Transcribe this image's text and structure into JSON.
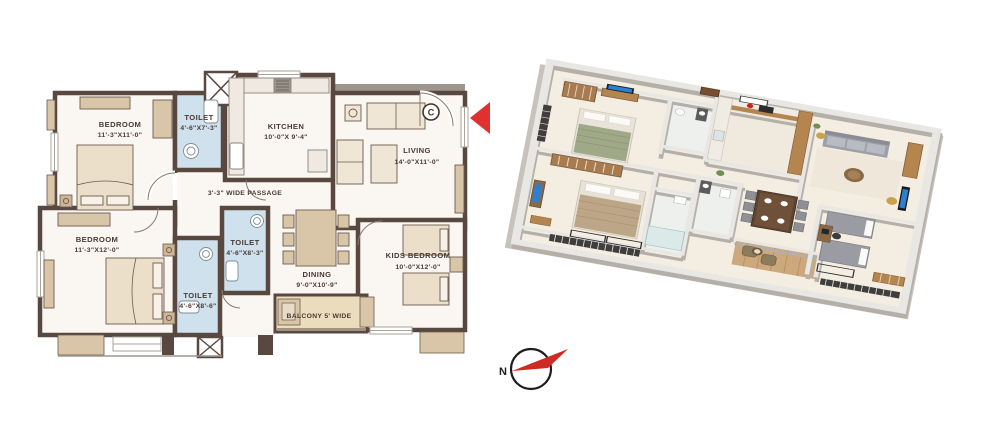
{
  "plan_2d": {
    "rooms": {
      "bedroom_top": {
        "name": "BEDROOM",
        "dims": "11'-3\"X11'-0\""
      },
      "toilet_top": {
        "name": "TOILET",
        "dims": "4'-6\"X7'-3\""
      },
      "kitchen": {
        "name": "KITCHEN",
        "dims": "10'-0\"X 9'-4\""
      },
      "living": {
        "name": "LIVING",
        "dims": "14'-0\"X11'-0\""
      },
      "bedroom_bottom": {
        "name": "BEDROOM",
        "dims": "11'-3\"X12'-0\""
      },
      "toilet_bottom": {
        "name": "TOILET",
        "dims": "4'-6\"X8'-6\""
      },
      "toilet_mid": {
        "name": "TOILET",
        "dims": "4'-6\"X8'-3\""
      },
      "dining": {
        "name": "DINING",
        "dims": "9'-0\"X10'-9\""
      },
      "kids_bedroom": {
        "name": "KIDS BEDROOM",
        "dims": "10'-0\"X12'-0\""
      }
    },
    "passage_label": "3'-3\" WIDE PASSAGE",
    "balcony_label": "BALCONY 5' WIDE",
    "entry_marker": "C"
  },
  "compass": {
    "north_label": "N"
  },
  "colors": {
    "wall": "#584840",
    "toilet_fill": "#cfe1ec",
    "furniture_tan": "#d9c6a8",
    "balcony_fill": "#ecdcbe",
    "arrow_red": "#e03030",
    "chajja_gray": "#9d968e",
    "floor_2d": "#faf6f1",
    "floor_3d": "#f3ede2",
    "wood_3d": "#b5854f"
  }
}
